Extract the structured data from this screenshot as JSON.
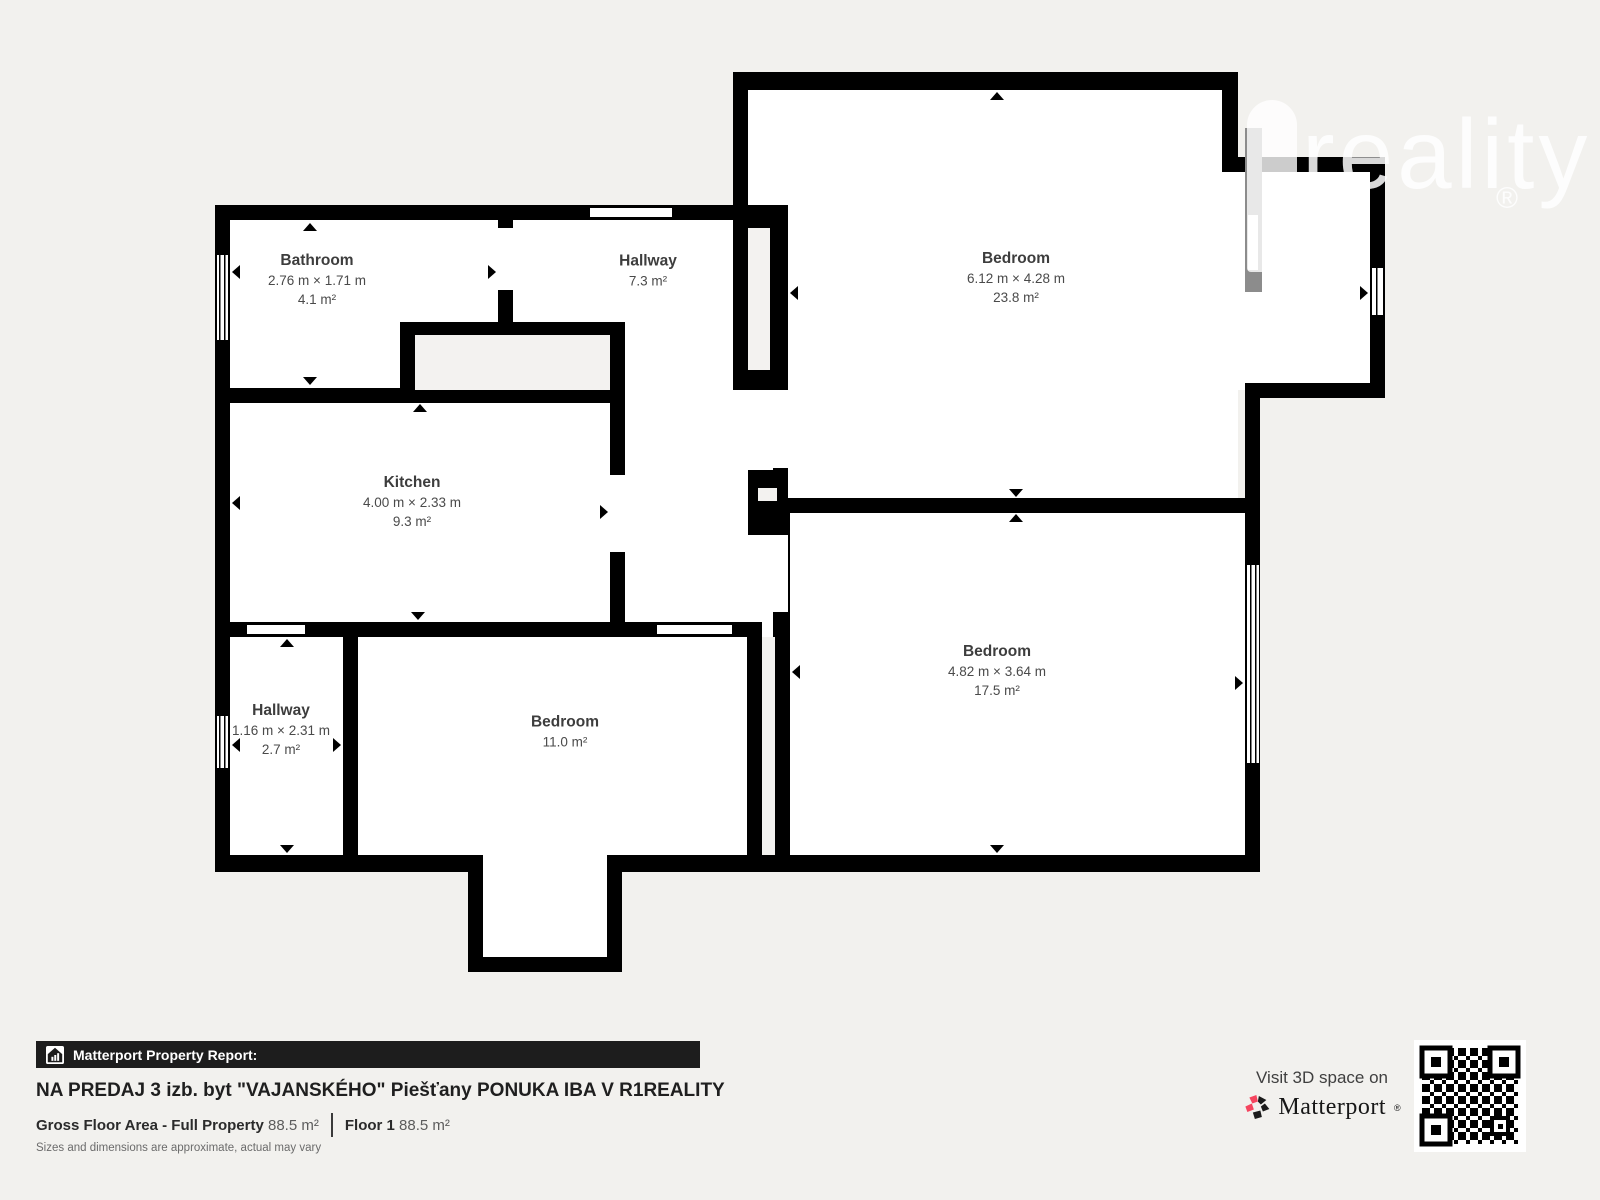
{
  "watermark": {
    "text": "reality",
    "registered": "®"
  },
  "rooms": [
    {
      "id": "bathroom",
      "name": "Bathroom",
      "dimensions": "2.76 m × 1.71 m",
      "area": "4.1 m²"
    },
    {
      "id": "hallway-top",
      "name": "Hallway",
      "dimensions": "",
      "area": "7.3 m²"
    },
    {
      "id": "bedroom-top",
      "name": "Bedroom",
      "dimensions": "6.12 m × 4.28 m",
      "area": "23.8 m²"
    },
    {
      "id": "kitchen",
      "name": "Kitchen",
      "dimensions": "4.00 m × 2.33 m",
      "area": "9.3 m²"
    },
    {
      "id": "hallway-small",
      "name": "Hallway",
      "dimensions": "1.16 m × 2.31 m",
      "area": "2.7 m²"
    },
    {
      "id": "bedroom-bottom",
      "name": "Bedroom",
      "dimensions": "",
      "area": "11.0 m²"
    },
    {
      "id": "bedroom-right",
      "name": "Bedroom",
      "dimensions": "4.82 m × 3.64 m",
      "area": "17.5 m²"
    }
  ],
  "footer": {
    "report_label": "Matterport Property Report:",
    "title": "NA PREDAJ 3 izb. byt \"VAJANSKÉHO\" Piešťany PONUKA IBA V R1REALITY",
    "gross_floor_label": "Gross Floor Area - Full Property",
    "gross_floor_value": "88.5 m²",
    "floor_label": "Floor 1",
    "floor_value": "88.5 m²",
    "disclaimer": "Sizes and dimensions are approximate, actual may vary",
    "visit_label": "Visit 3D space on",
    "brand": "Matterport",
    "brand_mark": "®"
  },
  "colors": {
    "background": "#f2f1ee",
    "wall": "#000000",
    "room_fill": "#ffffff",
    "shaft_fill": "#f3f2f0",
    "accent_red": "#f5455f",
    "report_bar_bg": "#1d1d1d"
  }
}
